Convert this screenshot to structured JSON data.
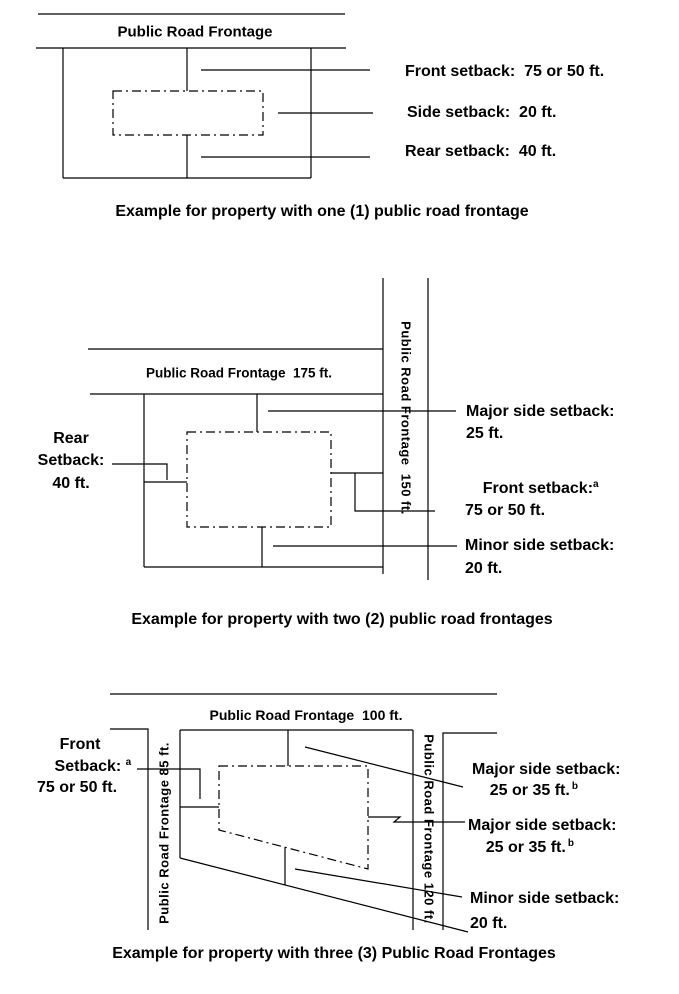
{
  "page": {
    "background": "#ffffff",
    "line_color": "#000000"
  },
  "diagram1": {
    "road_label": "Public Road Frontage",
    "front_label": "Front setback:  75 or 50 ft.",
    "side_label": "Side setback:  20 ft.",
    "rear_label": "Rear setback:  40 ft.",
    "caption": "Example for property with one (1) public road frontage"
  },
  "diagram2": {
    "road_label_top": "Public Road Frontage  175 ft.",
    "road_label_right": "Public Road Frontage  150 ft.",
    "rear_label": {
      "line1": "Rear",
      "line2": "Setback:",
      "line3": "40 ft."
    },
    "major_label": {
      "line1": "Major side setback:",
      "line2": "25 ft."
    },
    "front_label": {
      "line1": "Front setback:",
      "sup": "a",
      "line2": "75 or 50 ft."
    },
    "minor_label": {
      "line1": "Minor side setback:",
      "line2": "20 ft."
    },
    "caption": "Example for property with two (2) public road frontages"
  },
  "diagram3": {
    "road_label_top": "Public Road Frontage  100 ft.",
    "road_label_left": "Public Road Frontage 85 ft.",
    "road_label_right": "Public Road Frontage 120 ft.",
    "front_label": {
      "line1": "Front",
      "line2": "Setback: ",
      "sup": "a",
      "line3": "75 or 50 ft."
    },
    "major_label_1": {
      "line1": "Major side setback:",
      "line2": "25 or 35 ft.",
      "sup": "b"
    },
    "major_label_2": {
      "line1": "Major side setback:",
      "line2": "25 or 35 ft.",
      "sup": "b"
    },
    "minor_label": {
      "line1": "Minor side setback:",
      "line2": "20 ft."
    },
    "caption": "Example for property with three (3) Public Road Frontages"
  }
}
